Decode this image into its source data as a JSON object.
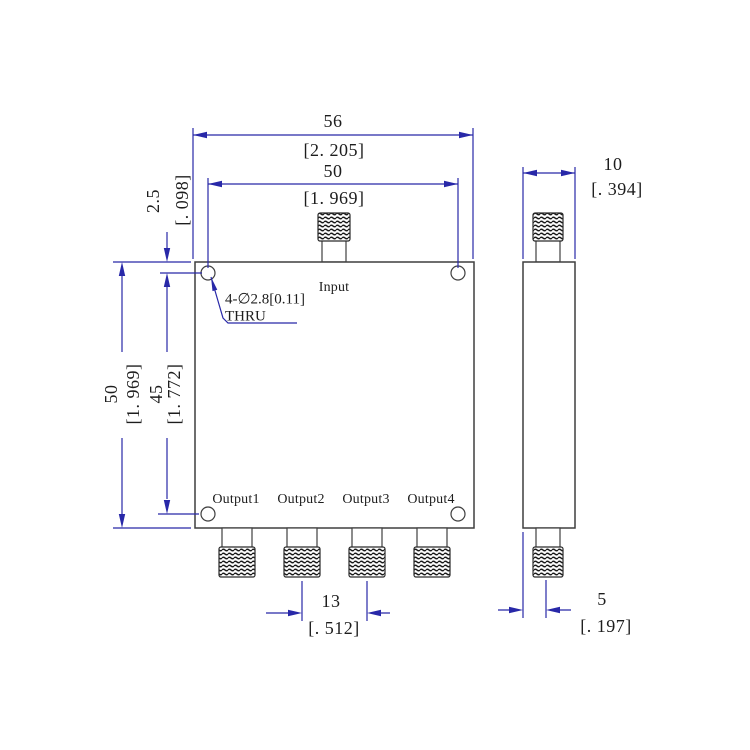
{
  "labels": {
    "input": "Input",
    "output1": "Output1",
    "output2": "Output2",
    "output3": "Output3",
    "output4": "Output4",
    "hole_note_line1": "4-∅2.8[0.11]",
    "hole_note_line2": "THRU"
  },
  "dimensions": {
    "body_width": {
      "mm": "56",
      "inch": "[2. 205]"
    },
    "hole_span_x": {
      "mm": "50",
      "inch": "[1. 969]"
    },
    "hole_top_offset": {
      "mm": "2.5",
      "inch": "[. 098]"
    },
    "body_height": {
      "mm": "50",
      "inch": "[1. 969]"
    },
    "hole_span_y": {
      "mm": "45",
      "inch": "[1. 772]"
    },
    "output_pitch": {
      "mm": "13",
      "inch": "[. 512]"
    },
    "side_depth": {
      "mm": "10",
      "inch": "[. 394]"
    },
    "connector_offset": {
      "mm": "5",
      "inch": "[. 197]"
    }
  },
  "colors": {
    "dimension_blue": "#2828a8",
    "outline_dark": "#3f3f3f",
    "text_black": "#1d1d1d",
    "background": "#ffffff"
  }
}
